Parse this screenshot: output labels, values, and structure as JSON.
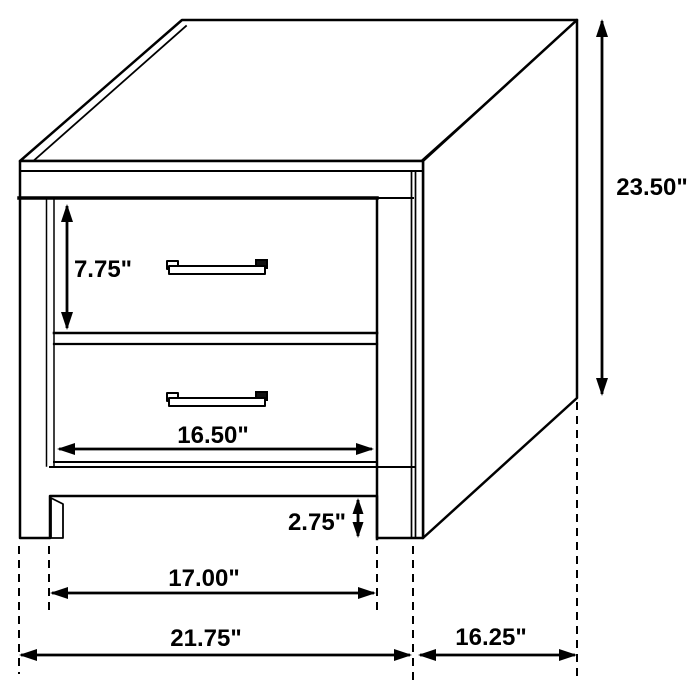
{
  "diagram": {
    "title": "2-drawer nightstand dimension drawing",
    "units": "inches",
    "colors": {
      "background": "#ffffff",
      "line": "#000000",
      "text": "#000000"
    },
    "dimensions": {
      "overall_height": {
        "label": "23.50\"",
        "value": 23.5
      },
      "drawer_height": {
        "label": "7.75\"",
        "value": 7.75
      },
      "drawer_width": {
        "label": "16.50\"",
        "value": 16.5
      },
      "base_clearance": {
        "label": "2.75\"",
        "value": 2.75
      },
      "leg_span_width": {
        "label": "17.00\"",
        "value": 17.0
      },
      "overall_width": {
        "label": "21.75\"",
        "value": 21.75
      },
      "overall_depth": {
        "label": "16.25\"",
        "value": 16.25
      }
    }
  }
}
